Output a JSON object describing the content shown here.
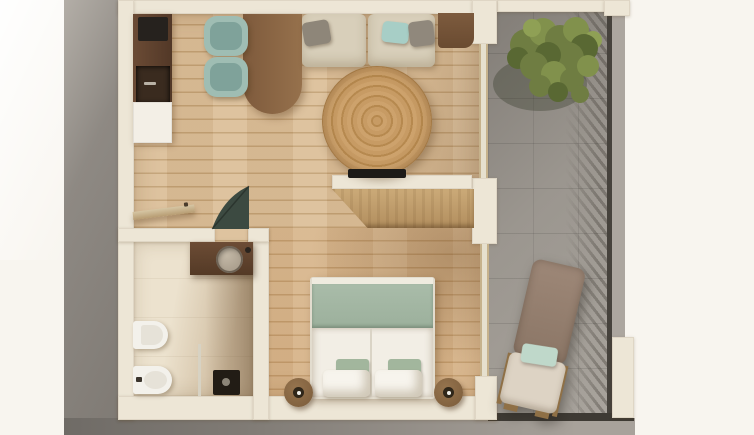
{
  "scene": {
    "title": "Apartment floor plan — photoreal top-down 3D render",
    "view": "top-down",
    "no_visible_text": true
  },
  "rooms": {
    "kitchen": {
      "label": "kitchen and dining area",
      "floor": "light oak planks"
    },
    "living": {
      "label": "living room",
      "floor": "light oak planks"
    },
    "hallway": {
      "label": "entry hallway",
      "floor": "light oak planks"
    },
    "bathroom": {
      "label": "bathroom",
      "floor": "beige stone tile"
    },
    "bedroom": {
      "label": "bedroom",
      "floor": "oak planks"
    },
    "terrace": {
      "label": "terrace / balcony",
      "floor": "gray concrete tile"
    }
  },
  "furniture": {
    "kitchen": [
      "tall-cabinet-column",
      "cooktop",
      "oven-niche",
      "white-base-cabinet",
      "wood-dining-table",
      "teal-chair",
      "teal-chair"
    ],
    "living": [
      "two-seat-beige-sofa",
      "gray-pillow",
      "teal-pillow",
      "gray-pillow",
      "round-jute-rug",
      "wall-tv",
      "wood-console"
    ],
    "hallway": [
      "open-entry-door",
      "open-green-door",
      "wardrobe-cabinet"
    ],
    "bathroom": [
      "walnut-vanity",
      "round-stone-sink",
      "faucet",
      "wall-hung-toilet",
      "bidet",
      "glass-shower-screen",
      "shower-tray"
    ],
    "bedroom": [
      "double-bed",
      "sage-blanket",
      "white-duvet",
      "sage-pillows",
      "white-pillows",
      "round-wood-stool",
      "round-wood-stool"
    ],
    "terrace": [
      "green-tree",
      "sun-lounger",
      "mint-pillow",
      "slatted-railing"
    ]
  },
  "palette": {
    "bg": "#F8F5EF",
    "slab-hi": "#B3AEA7",
    "slab-mid": "#8E8983",
    "slab-lo": "#7F7A74",
    "slab-edge": "#6F6B66",
    "slab-bot2": "#A8A29B",
    "edge-dark": "#3E3A34",
    "wall": "#EDE6D6",
    "wood1": "#DCC09A",
    "wood2": "#C3A276",
    "tile1": "#ECE2CE",
    "tile2": "#CDB99C",
    "terrace1": "#9B968F",
    "terrace2": "#827D77",
    "terrace3": "#A9A49D",
    "terrace-outer": "#ACA69F",
    "railing": "#46423C",
    "frame": "#C6B28C",
    "glass": "#E6E0CE",
    "glass2": "#D7D2C3",
    "cab1": "#6B4B35",
    "cab2": "#523827",
    "appliance": "#26221E",
    "niche": "#3A2B1F",
    "cab-white": "#F3EFE6",
    "table1": "#7E5A3C",
    "table2": "#96714C",
    "chair": "#9FBDB3",
    "chair-seat": "#7FA29A",
    "sofa": "#D8CFBA",
    "pillow-gray": "#8E8679",
    "pillow-gray2": "#90887C",
    "pillow-teal": "#A7CEC6",
    "console": "#7D5B3E",
    "rug1": "#C79B64",
    "rug2": "#B6894F",
    "rug3": "#CDA26C",
    "tv": "#1D1B18",
    "wd1": "#CBAA78",
    "wd2": "#B28E5E",
    "entry-door": "#D6C6A4",
    "door-green": "#3C4A41",
    "vanity": "#6C4C35",
    "sink1": "#C3B8A6",
    "sink2": "#9F9382",
    "fix-white": "#F3F1EB",
    "fix-inner": "#E6E2D8",
    "shower": "#221C15",
    "bed-frame": "#E2DCCE",
    "blanket": "#A9BCA9",
    "duvet": "#F2EEE5",
    "duvet-line": "#DAD4C6",
    "pillow-sage": "#A2B69D",
    "pillow-white": "#F7F4ED",
    "stool1": "#96744E",
    "stool2": "#7A5B3A",
    "stool-hole": "#2F2619",
    "tree-dark": "#596833",
    "tree-mid": "#6F7D42",
    "tree-light": "#81914C",
    "tree-bright": "#8FA055",
    "tree-shadow": "rgba(45,50,30,0.32)",
    "lg-back": "#9D8777",
    "lg-base": "#DDD3C4",
    "lg-pillow": "#BFD8CA",
    "lg-wood": "#8F7046"
  }
}
